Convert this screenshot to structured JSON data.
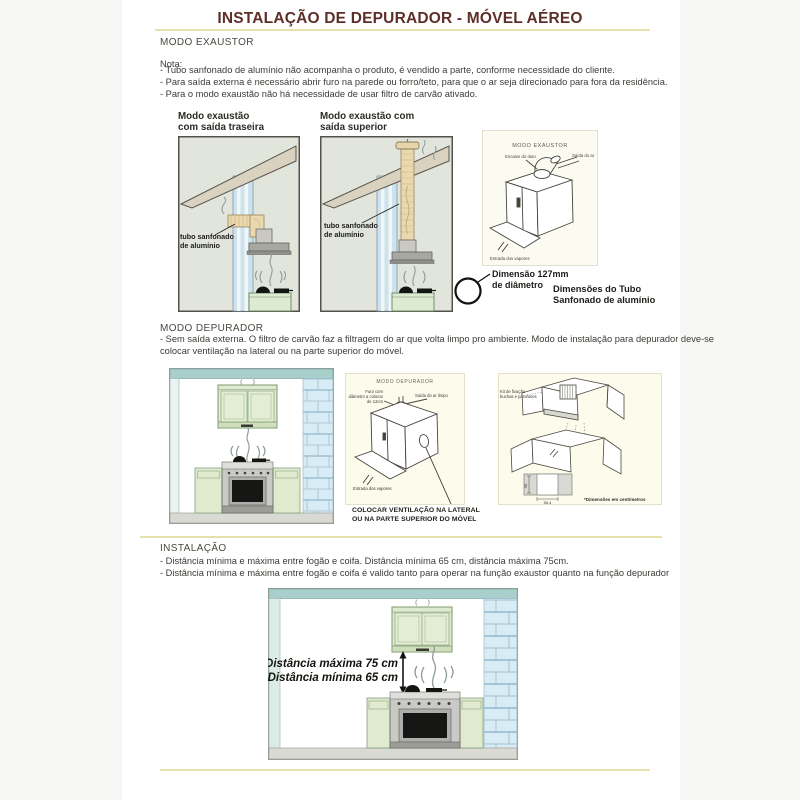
{
  "title": "INSTALAÇÃO DE DEPURADOR - MÓVEL AÉREO",
  "exaustor": {
    "heading": "MODO EXAUSTOR",
    "nota": "Nota:",
    "notes": [
      "- Tubo sanfonado de alumínio não acompanha o produto, é vendido a parte, conforme necessidade do cliente.",
      "- Para saída externa é necessário abrir furo na parede ou forro/teto, para que o ar seja direcionado para fora da residência.",
      "- Para o modo exaustão não há necessidade de usar filtro de carvão ativado."
    ],
    "diag_traseira": {
      "title1": "Modo exaustão",
      "title2": "com saída traseira",
      "tube1": "tubo sanfonado",
      "tube2": "de alumínio"
    },
    "diag_superior": {
      "title1": "Modo exaustão com",
      "title2": "saída superior",
      "tube1": "tubo sanfonado",
      "tube2": "de alumínio"
    },
    "diag_unit": {
      "title": "MODO EXAUSTOR",
      "duct": "Encaixe do duto",
      "air_out": "Saída do ar",
      "vapors": "Entrada dos vapores"
    },
    "tube_dim": {
      "dim1": "Dimensão 127mm",
      "dim2": "de diâmetro",
      "cap1": "Dimensões do Tubo",
      "cap2": "Sanfonado de alumínio"
    }
  },
  "depurador": {
    "heading": "MODO DEPURADOR",
    "line1": "- Sem saída externa. O filtro de carvão faz a filtragem do ar que volta limpo pro ambiente. Modo de instalação para depurador deve-se",
    "line2": "colocar ventilação na lateral ou na parte superior do móvel.",
    "diag_unit": {
      "title": "MODO DEPURADOR",
      "hole1": "Furo com",
      "hole2": "diâmetro a colocar",
      "hole3": "de 12cm",
      "air_out": "Saída do ar limpo",
      "vapors": "Entrada dos vapores",
      "note1": "COLOCAR VENTILAÇÃO NA LATERAL",
      "note2": "OU NA PARTE SUPERIOR DO MÓVEL"
    },
    "diag_cabinet": {
      "kit1": "Kit de fixação",
      "kit2": "buchas e parafusos",
      "dim_v": "30",
      "dim_h": "55,4",
      "caption": "*Dimensões em centímetros"
    }
  },
  "instalacao": {
    "heading": "INSTALAÇÃO",
    "bullets": [
      "- Distância mínima e máxima entre fogão e coifa. Distância mínima 65 cm, distância máxima 75cm.",
      "- Distância mínima e máxima entre fogão e coifa é valido tanto para operar na função exaustor quanto na função depurador"
    ],
    "dist_max": "Distância máxima 75 cm",
    "dist_min": "Distância mínima 65 cm"
  },
  "colors": {
    "rule": "#e9e1ab",
    "title": "#5e2f27",
    "teal_band": "#a9cfcc",
    "brick": "#d7ecf5",
    "cabinet_green": "#dfeacf"
  }
}
